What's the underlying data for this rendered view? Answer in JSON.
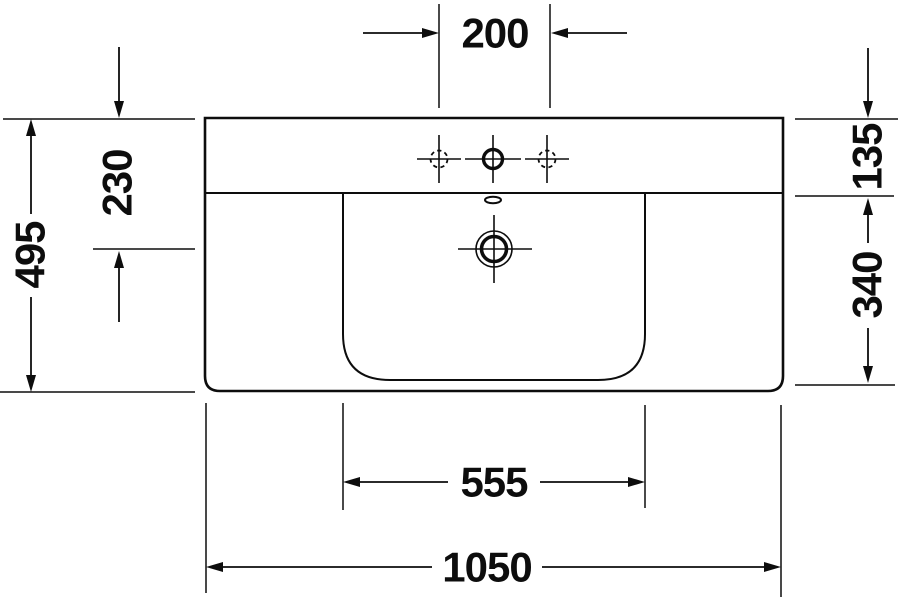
{
  "drawing": {
    "title": "washbasin-technical-drawing",
    "unit": "mm",
    "dimensions": {
      "tap_hole_spacing": "200",
      "rim_to_drain_center": "230",
      "overall_depth": "495",
      "rim_to_deck_edge": "135",
      "deck_to_bowl_front": "340",
      "bowl_width": "555",
      "overall_width": "1050"
    },
    "colors": {
      "line": "#0d0d0d",
      "background": "#ffffff"
    }
  }
}
